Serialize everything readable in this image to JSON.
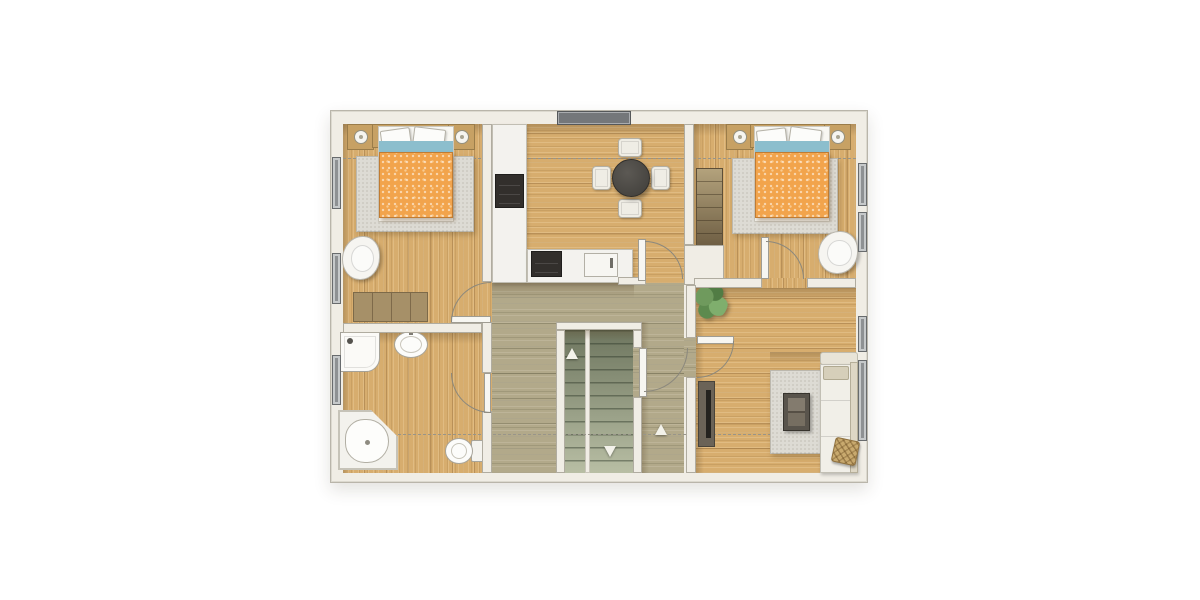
{
  "scene": {
    "type": "floor-plan",
    "storey": "upper-floor",
    "text_labels": []
  },
  "palette": {
    "wall": "#f0ede5",
    "oak": "#d7ad6e",
    "olive": "#b2a98a",
    "orange": "#f2a44c",
    "blue": "#8cbecd",
    "glass": "#8e9193",
    "rug": "#dddbd4",
    "wood": "#c7a164",
    "dash": "#98958a",
    "arc": "#8b887d"
  },
  "plan": {
    "name": "floor-plan-canvas",
    "items": [
      {
        "name": "plan-frame",
        "kind": "frame",
        "x": 330,
        "y": 110,
        "w": 538,
        "h": 373
      },
      {
        "name": "bedroom-left-floor",
        "kind": "floor-oak-v",
        "x": 343,
        "y": 124,
        "w": 139,
        "h": 199
      },
      {
        "name": "kitchen-floor",
        "kind": "floor-oak-h",
        "x": 492,
        "y": 124,
        "w": 192,
        "h": 159
      },
      {
        "name": "bedroom-right-floor",
        "kind": "floor-oak-v",
        "x": 694,
        "y": 124,
        "w": 162,
        "h": 154
      },
      {
        "name": "bathroom-floor",
        "kind": "floor-oak-v",
        "x": 343,
        "y": 333,
        "w": 139,
        "h": 140
      },
      {
        "name": "living-room-floor",
        "kind": "floor-oak-h",
        "x": 694,
        "y": 288,
        "w": 162,
        "h": 185
      },
      {
        "name": "hallway-floor-top",
        "kind": "floor-olive",
        "x": 492,
        "y": 283,
        "w": 192,
        "h": 39
      },
      {
        "name": "hallway-floor-left",
        "kind": "floor-olive",
        "x": 492,
        "y": 322,
        "w": 64,
        "h": 151
      },
      {
        "name": "hallway-floor-right",
        "kind": "floor-olive",
        "x": 642,
        "y": 322,
        "w": 42,
        "h": 151
      },
      {
        "name": "door-gap-floor-bedroom-left",
        "kind": "floor-oak-v",
        "x": 482,
        "y": 282,
        "w": 10,
        "h": 41
      },
      {
        "name": "door-gap-floor-bathroom",
        "kind": "floor-oak-v",
        "x": 482,
        "y": 373,
        "w": 10,
        "h": 39
      },
      {
        "name": "door-gap-floor-bedroom-right",
        "kind": "floor-oak-v",
        "x": 762,
        "y": 278,
        "w": 45,
        "h": 10
      },
      {
        "name": "door-gap-floor-living",
        "kind": "floor-olive",
        "x": 684,
        "y": 338,
        "w": 12,
        "h": 39
      },
      {
        "name": "door-gap-floor-stairs",
        "kind": "floor-olive",
        "x": 633,
        "y": 348,
        "w": 9,
        "h": 49
      },
      {
        "name": "stair-flight-up",
        "kind": "stairs",
        "x": 565,
        "y": 330,
        "w": 20,
        "h": 143
      },
      {
        "name": "stair-divider",
        "kind": "stair-div",
        "x": 585,
        "y": 330,
        "w": 5,
        "h": 143
      },
      {
        "name": "stair-flight-down",
        "kind": "stairs",
        "x": 590,
        "y": 330,
        "w": 43,
        "h": 143
      },
      {
        "name": "shadow-top-wall",
        "kind": "shadow-h",
        "x": 343,
        "y": 124,
        "w": 513,
        "h": 12
      },
      {
        "name": "shadow-left-wall",
        "kind": "shadow-v",
        "x": 343,
        "y": 124,
        "w": 7,
        "h": 349
      },
      {
        "name": "shadow-kitchen-counter",
        "kind": "shadow-h",
        "x": 492,
        "y": 283,
        "w": 142,
        "h": 15
      },
      {
        "name": "shadow-living-top-wall",
        "kind": "shadow-h",
        "x": 694,
        "y": 288,
        "w": 162,
        "h": 13
      },
      {
        "name": "shadow-bath-top-wall",
        "kind": "shadow-h",
        "x": 343,
        "y": 333,
        "w": 139,
        "h": 11
      },
      {
        "name": "shadow-kitchen-left-wall",
        "kind": "shadow-v",
        "x": 492,
        "y": 124,
        "w": 8,
        "h": 159
      },
      {
        "name": "shadow-bedroom-right-left-wall",
        "kind": "shadow-v",
        "x": 694,
        "y": 124,
        "w": 8,
        "h": 154
      },
      {
        "name": "shadow-stair-top",
        "kind": "shadow-h",
        "x": 556,
        "y": 330,
        "w": 77,
        "h": 10
      },
      {
        "name": "shadow-living-left-wall",
        "kind": "shadow-v",
        "x": 696,
        "y": 288,
        "w": 8,
        "h": 185
      },
      {
        "name": "shadow-hall-stair-wall",
        "kind": "shadow-v",
        "x": 642,
        "y": 322,
        "w": 7,
        "h": 151
      },
      {
        "name": "shadow-sofa-top",
        "kind": "shadow-h",
        "x": 770,
        "y": 352,
        "w": 86,
        "h": 12
      },
      {
        "name": "section-dashline-upper",
        "kind": "dashline",
        "x": 343,
        "y": 158,
        "w": 513,
        "h": 0
      },
      {
        "name": "section-dashline-lower",
        "kind": "dashline",
        "x": 343,
        "y": 434,
        "w": 513,
        "h": 0
      },
      {
        "name": "bedroom-left-rug",
        "kind": "rug",
        "x": 356,
        "y": 156,
        "w": 118,
        "h": 76
      },
      {
        "name": "bedroom-right-rug",
        "kind": "rug",
        "x": 732,
        "y": 158,
        "w": 106,
        "h": 76
      },
      {
        "name": "living-room-rug",
        "kind": "rug",
        "x": 770,
        "y": 370,
        "w": 52,
        "h": 84
      },
      {
        "name": "bedroom-left-nightstand-a",
        "kind": "nightstand",
        "x": 347,
        "y": 124,
        "w": 27,
        "h": 26
      },
      {
        "name": "bedroom-left-lamp-a",
        "kind": "lamp",
        "x": 354,
        "y": 130,
        "w": 14,
        "h": 14
      },
      {
        "name": "bedroom-left-headboard",
        "kind": "headboard",
        "x": 372,
        "y": 124,
        "w": 92,
        "h": 24
      },
      {
        "name": "bedroom-left-nightstand-b",
        "kind": "nightstand",
        "x": 448,
        "y": 124,
        "w": 27,
        "h": 26
      },
      {
        "name": "bedroom-left-lamp-b",
        "kind": "lamp",
        "x": 455,
        "y": 130,
        "w": 14,
        "h": 14
      },
      {
        "name": "bedroom-left-bed",
        "kind": "bed-base",
        "x": 378,
        "y": 126,
        "w": 76,
        "h": 96
      },
      {
        "name": "bedroom-left-pillow-a",
        "kind": "pillow",
        "x": 381,
        "y": 129,
        "w": 30,
        "h": 21,
        "rot": -8
      },
      {
        "name": "bedroom-left-pillow-b",
        "kind": "pillow",
        "x": 413,
        "y": 128,
        "w": 32,
        "h": 22,
        "rot": 7
      },
      {
        "name": "bedroom-left-blanket-fold",
        "kind": "bed-blue",
        "x": 379,
        "y": 141,
        "w": 74,
        "h": 26
      },
      {
        "name": "bedroom-left-duvet",
        "kind": "bed-duvet",
        "x": 379,
        "y": 152,
        "w": 74,
        "h": 66
      },
      {
        "name": "bedroom-left-armchair",
        "kind": "armchair",
        "x": 342,
        "y": 236,
        "w": 38,
        "h": 44
      },
      {
        "name": "bedroom-left-dresser",
        "kind": "dresser",
        "x": 353,
        "y": 292,
        "w": 75,
        "h": 30
      },
      {
        "name": "bedroom-right-nightstand-a",
        "kind": "nightstand",
        "x": 726,
        "y": 124,
        "w": 27,
        "h": 26
      },
      {
        "name": "bedroom-right-lamp-a",
        "kind": "lamp",
        "x": 733,
        "y": 130,
        "w": 14,
        "h": 14
      },
      {
        "name": "bedroom-right-headboard",
        "kind": "headboard",
        "x": 750,
        "y": 124,
        "w": 88,
        "h": 24
      },
      {
        "name": "bedroom-right-nightstand-b",
        "kind": "nightstand",
        "x": 824,
        "y": 124,
        "w": 27,
        "h": 26
      },
      {
        "name": "bedroom-right-lamp-b",
        "kind": "lamp",
        "x": 831,
        "y": 130,
        "w": 14,
        "h": 14
      },
      {
        "name": "bedroom-right-bed",
        "kind": "bed-base",
        "x": 754,
        "y": 126,
        "w": 76,
        "h": 96
      },
      {
        "name": "bedroom-right-pillow-a",
        "kind": "pillow",
        "x": 757,
        "y": 129,
        "w": 30,
        "h": 21,
        "rot": -7
      },
      {
        "name": "bedroom-right-pillow-b",
        "kind": "pillow",
        "x": 789,
        "y": 128,
        "w": 32,
        "h": 22,
        "rot": 8
      },
      {
        "name": "bedroom-right-blanket-fold",
        "kind": "bed-blue",
        "x": 755,
        "y": 141,
        "w": 74,
        "h": 26
      },
      {
        "name": "bedroom-right-duvet",
        "kind": "bed-duvet",
        "x": 755,
        "y": 152,
        "w": 74,
        "h": 66
      },
      {
        "name": "bedroom-right-armchair",
        "kind": "armchair",
        "x": 818,
        "y": 231,
        "w": 40,
        "h": 43
      },
      {
        "name": "bedroom-right-wardrobe",
        "kind": "wardrobe",
        "x": 696,
        "y": 168,
        "w": 27,
        "h": 78
      },
      {
        "name": "kitchen-tall-counter",
        "kind": "counter",
        "x": 492,
        "y": 124,
        "w": 35,
        "h": 159
      },
      {
        "name": "kitchen-appliance",
        "kind": "appliance",
        "x": 495,
        "y": 174,
        "w": 29,
        "h": 34
      },
      {
        "name": "kitchen-base-counter",
        "kind": "counter",
        "x": 527,
        "y": 249,
        "w": 106,
        "h": 34
      },
      {
        "name": "kitchen-cooktop",
        "kind": "appliance",
        "x": 531,
        "y": 251,
        "w": 31,
        "h": 26
      },
      {
        "name": "kitchen-sink",
        "kind": "ksink",
        "x": 584,
        "y": 253,
        "w": 34,
        "h": 24
      },
      {
        "name": "dining-chair-top",
        "kind": "kchair",
        "x": 618,
        "y": 138,
        "w": 24,
        "h": 19
      },
      {
        "name": "dining-chair-bottom",
        "kind": "kchair",
        "x": 618,
        "y": 199,
        "w": 24,
        "h": 19
      },
      {
        "name": "dining-chair-left",
        "kind": "kchair",
        "x": 592,
        "y": 166,
        "w": 19,
        "h": 24
      },
      {
        "name": "dining-chair-right",
        "kind": "kchair",
        "x": 651,
        "y": 166,
        "w": 19,
        "h": 24
      },
      {
        "name": "dining-table",
        "kind": "ktable",
        "x": 612,
        "y": 159,
        "w": 38,
        "h": 38
      },
      {
        "name": "shower",
        "kind": "shower",
        "x": 340,
        "y": 332,
        "w": 40,
        "h": 40
      },
      {
        "name": "shower-drain",
        "kind": "dot-dark",
        "x": 347,
        "y": 338,
        "w": 6,
        "h": 6
      },
      {
        "name": "bathroom-basin",
        "kind": "basin",
        "x": 394,
        "y": 331,
        "w": 34,
        "h": 27
      },
      {
        "name": "bathroom-basin-faucet",
        "kind": "faucet",
        "x": 409,
        "y": 328,
        "w": 4,
        "h": 7
      },
      {
        "name": "corner-bathtub",
        "kind": "tub",
        "x": 338,
        "y": 410,
        "w": 60,
        "h": 60
      },
      {
        "name": "corner-bathtub-basin",
        "kind": "tub-basin",
        "x": 345,
        "y": 419,
        "w": 44,
        "h": 44
      },
      {
        "name": "toilet-tank",
        "kind": "toilet-tank",
        "x": 471,
        "y": 440,
        "w": 13,
        "h": 22
      },
      {
        "name": "toilet-bowl",
        "kind": "toilet-bowl",
        "x": 445,
        "y": 438,
        "w": 28,
        "h": 26
      },
      {
        "name": "tv-sideboard",
        "kind": "tv-board",
        "x": 698,
        "y": 381,
        "w": 17,
        "h": 66
      },
      {
        "name": "tv-screen-line",
        "kind": "tv-line",
        "x": 706,
        "y": 390,
        "w": 5,
        "h": 48
      },
      {
        "name": "coffee-table",
        "kind": "coffee-table",
        "x": 783,
        "y": 393,
        "w": 27,
        "h": 38
      },
      {
        "name": "sofa-armrest-top",
        "kind": "sofa-arm",
        "x": 820,
        "y": 352,
        "w": 38,
        "h": 13
      },
      {
        "name": "sofa-body",
        "kind": "sofa-body",
        "x": 820,
        "y": 364,
        "w": 38,
        "h": 109
      },
      {
        "name": "sofa-backrest",
        "kind": "sofa-back",
        "x": 850,
        "y": 362,
        "w": 8,
        "h": 111
      },
      {
        "name": "sofa-chaise-cushion",
        "kind": "sofa-chaise",
        "x": 823,
        "y": 366,
        "w": 26,
        "h": 14
      },
      {
        "name": "sofa-deco-pillow",
        "kind": "deco-pillow",
        "x": 833,
        "y": 439,
        "w": 25,
        "h": 25,
        "rot": 12
      },
      {
        "name": "hallway-plant",
        "kind": "plant",
        "x": 694,
        "y": 284,
        "w": 34,
        "h": 36
      },
      {
        "name": "wall-bedroomleft-hall-upper",
        "kind": "wall",
        "x": 482,
        "y": 124,
        "w": 10,
        "h": 158
      },
      {
        "name": "wall-bedroomleft-hall-mid",
        "kind": "wall",
        "x": 482,
        "y": 322,
        "w": 10,
        "h": 51
      },
      {
        "name": "wall-bathroom-hall-lower",
        "kind": "wall",
        "x": 482,
        "y": 411,
        "w": 10,
        "h": 62
      },
      {
        "name": "wall-bedroomleft-bathroom",
        "kind": "wall",
        "x": 343,
        "y": 323,
        "w": 139,
        "h": 10
      },
      {
        "name": "wall-kitchen-bedroomright",
        "kind": "wall",
        "x": 684,
        "y": 124,
        "w": 10,
        "h": 121
      },
      {
        "name": "wall-shaft-block",
        "kind": "wall",
        "x": 684,
        "y": 245,
        "w": 40,
        "h": 40
      },
      {
        "name": "wall-kitchen-hall-stub",
        "kind": "wall",
        "x": 618,
        "y": 277,
        "w": 28,
        "h": 8
      },
      {
        "name": "wall-bedroomright-living-a",
        "kind": "wall",
        "x": 694,
        "y": 278,
        "w": 68,
        "h": 10
      },
      {
        "name": "wall-bedroomright-living-b",
        "kind": "wall",
        "x": 807,
        "y": 278,
        "w": 49,
        "h": 10
      },
      {
        "name": "wall-hall-living-upper",
        "kind": "wall",
        "x": 686,
        "y": 285,
        "w": 10,
        "h": 53
      },
      {
        "name": "wall-hall-living-lower",
        "kind": "wall",
        "x": 686,
        "y": 377,
        "w": 10,
        "h": 96
      },
      {
        "name": "stairwell-wall-top",
        "kind": "wall",
        "x": 556,
        "y": 322,
        "w": 86,
        "h": 8
      },
      {
        "name": "stairwell-wall-left",
        "kind": "wall",
        "x": 556,
        "y": 330,
        "w": 9,
        "h": 143
      },
      {
        "name": "stairwell-wall-right-a",
        "kind": "wall",
        "x": 633,
        "y": 330,
        "w": 9,
        "h": 18
      },
      {
        "name": "stairwell-wall-right-b",
        "kind": "wall",
        "x": 633,
        "y": 397,
        "w": 9,
        "h": 76
      },
      {
        "name": "window-left-bedroom-a",
        "kind": "window",
        "x": 332,
        "y": 157,
        "w": 9,
        "h": 52
      },
      {
        "name": "window-left-bedroom-b",
        "kind": "window",
        "x": 332,
        "y": 253,
        "w": 9,
        "h": 51
      },
      {
        "name": "window-left-bathroom",
        "kind": "window",
        "x": 332,
        "y": 355,
        "w": 9,
        "h": 50
      },
      {
        "name": "window-top-kitchen",
        "kind": "window-top",
        "x": 557,
        "y": 111,
        "w": 74,
        "h": 14
      },
      {
        "name": "window-right-bedroom-a",
        "kind": "window",
        "x": 858,
        "y": 163,
        "w": 9,
        "h": 43
      },
      {
        "name": "window-right-bedroom-b",
        "kind": "window",
        "x": 858,
        "y": 212,
        "w": 9,
        "h": 40
      },
      {
        "name": "window-right-living-a",
        "kind": "window",
        "x": 858,
        "y": 316,
        "w": 9,
        "h": 36
      },
      {
        "name": "window-right-living-b",
        "kind": "window",
        "x": 858,
        "y": 360,
        "w": 9,
        "h": 81
      },
      {
        "name": "door-leaf-bedroom-left",
        "kind": "door-leaf",
        "x": 451,
        "y": 316,
        "w": 40,
        "h": 7
      },
      {
        "name": "door-arc-bedroom-left",
        "kind": "arc arc-tl",
        "x": 451,
        "y": 282,
        "w": 40,
        "h": 40
      },
      {
        "name": "door-leaf-bathroom",
        "kind": "door-leaf",
        "x": 484,
        "y": 373,
        "w": 7,
        "h": 40
      },
      {
        "name": "door-arc-bathroom",
        "kind": "arc arc-bl",
        "x": 451,
        "y": 373,
        "w": 40,
        "h": 40
      },
      {
        "name": "door-leaf-kitchen",
        "kind": "door-leaf",
        "x": 638,
        "y": 239,
        "w": 8,
        "h": 42
      },
      {
        "name": "door-arc-kitchen",
        "kind": "arc arc-tr",
        "x": 645,
        "y": 241,
        "w": 38,
        "h": 38
      },
      {
        "name": "door-leaf-bedroom-right",
        "kind": "door-leaf",
        "x": 761,
        "y": 237,
        "w": 8,
        "h": 42
      },
      {
        "name": "door-arc-bedroom-right",
        "kind": "arc arc-tr",
        "x": 766,
        "y": 241,
        "w": 38,
        "h": 38
      },
      {
        "name": "door-leaf-living",
        "kind": "door-leaf",
        "x": 697,
        "y": 336,
        "w": 37,
        "h": 8
      },
      {
        "name": "door-arc-living",
        "kind": "arc arc-br",
        "x": 697,
        "y": 341,
        "w": 37,
        "h": 37
      },
      {
        "name": "door-leaf-stairwell",
        "kind": "door-leaf",
        "x": 639,
        "y": 348,
        "w": 8,
        "h": 49
      },
      {
        "name": "door-arc-stairwell",
        "kind": "arc arc-br",
        "x": 644,
        "y": 348,
        "w": 44,
        "h": 44
      },
      {
        "name": "stair-arrow-up",
        "kind": "arrow-up",
        "x": 566,
        "y": 348,
        "w": 0,
        "h": 0
      },
      {
        "name": "stair-arrow-down",
        "kind": "arrow-down",
        "x": 604,
        "y": 446,
        "w": 0,
        "h": 0
      },
      {
        "name": "hallway-arrow-up",
        "kind": "arrow-up",
        "x": 655,
        "y": 424,
        "w": 0,
        "h": 0
      }
    ]
  }
}
